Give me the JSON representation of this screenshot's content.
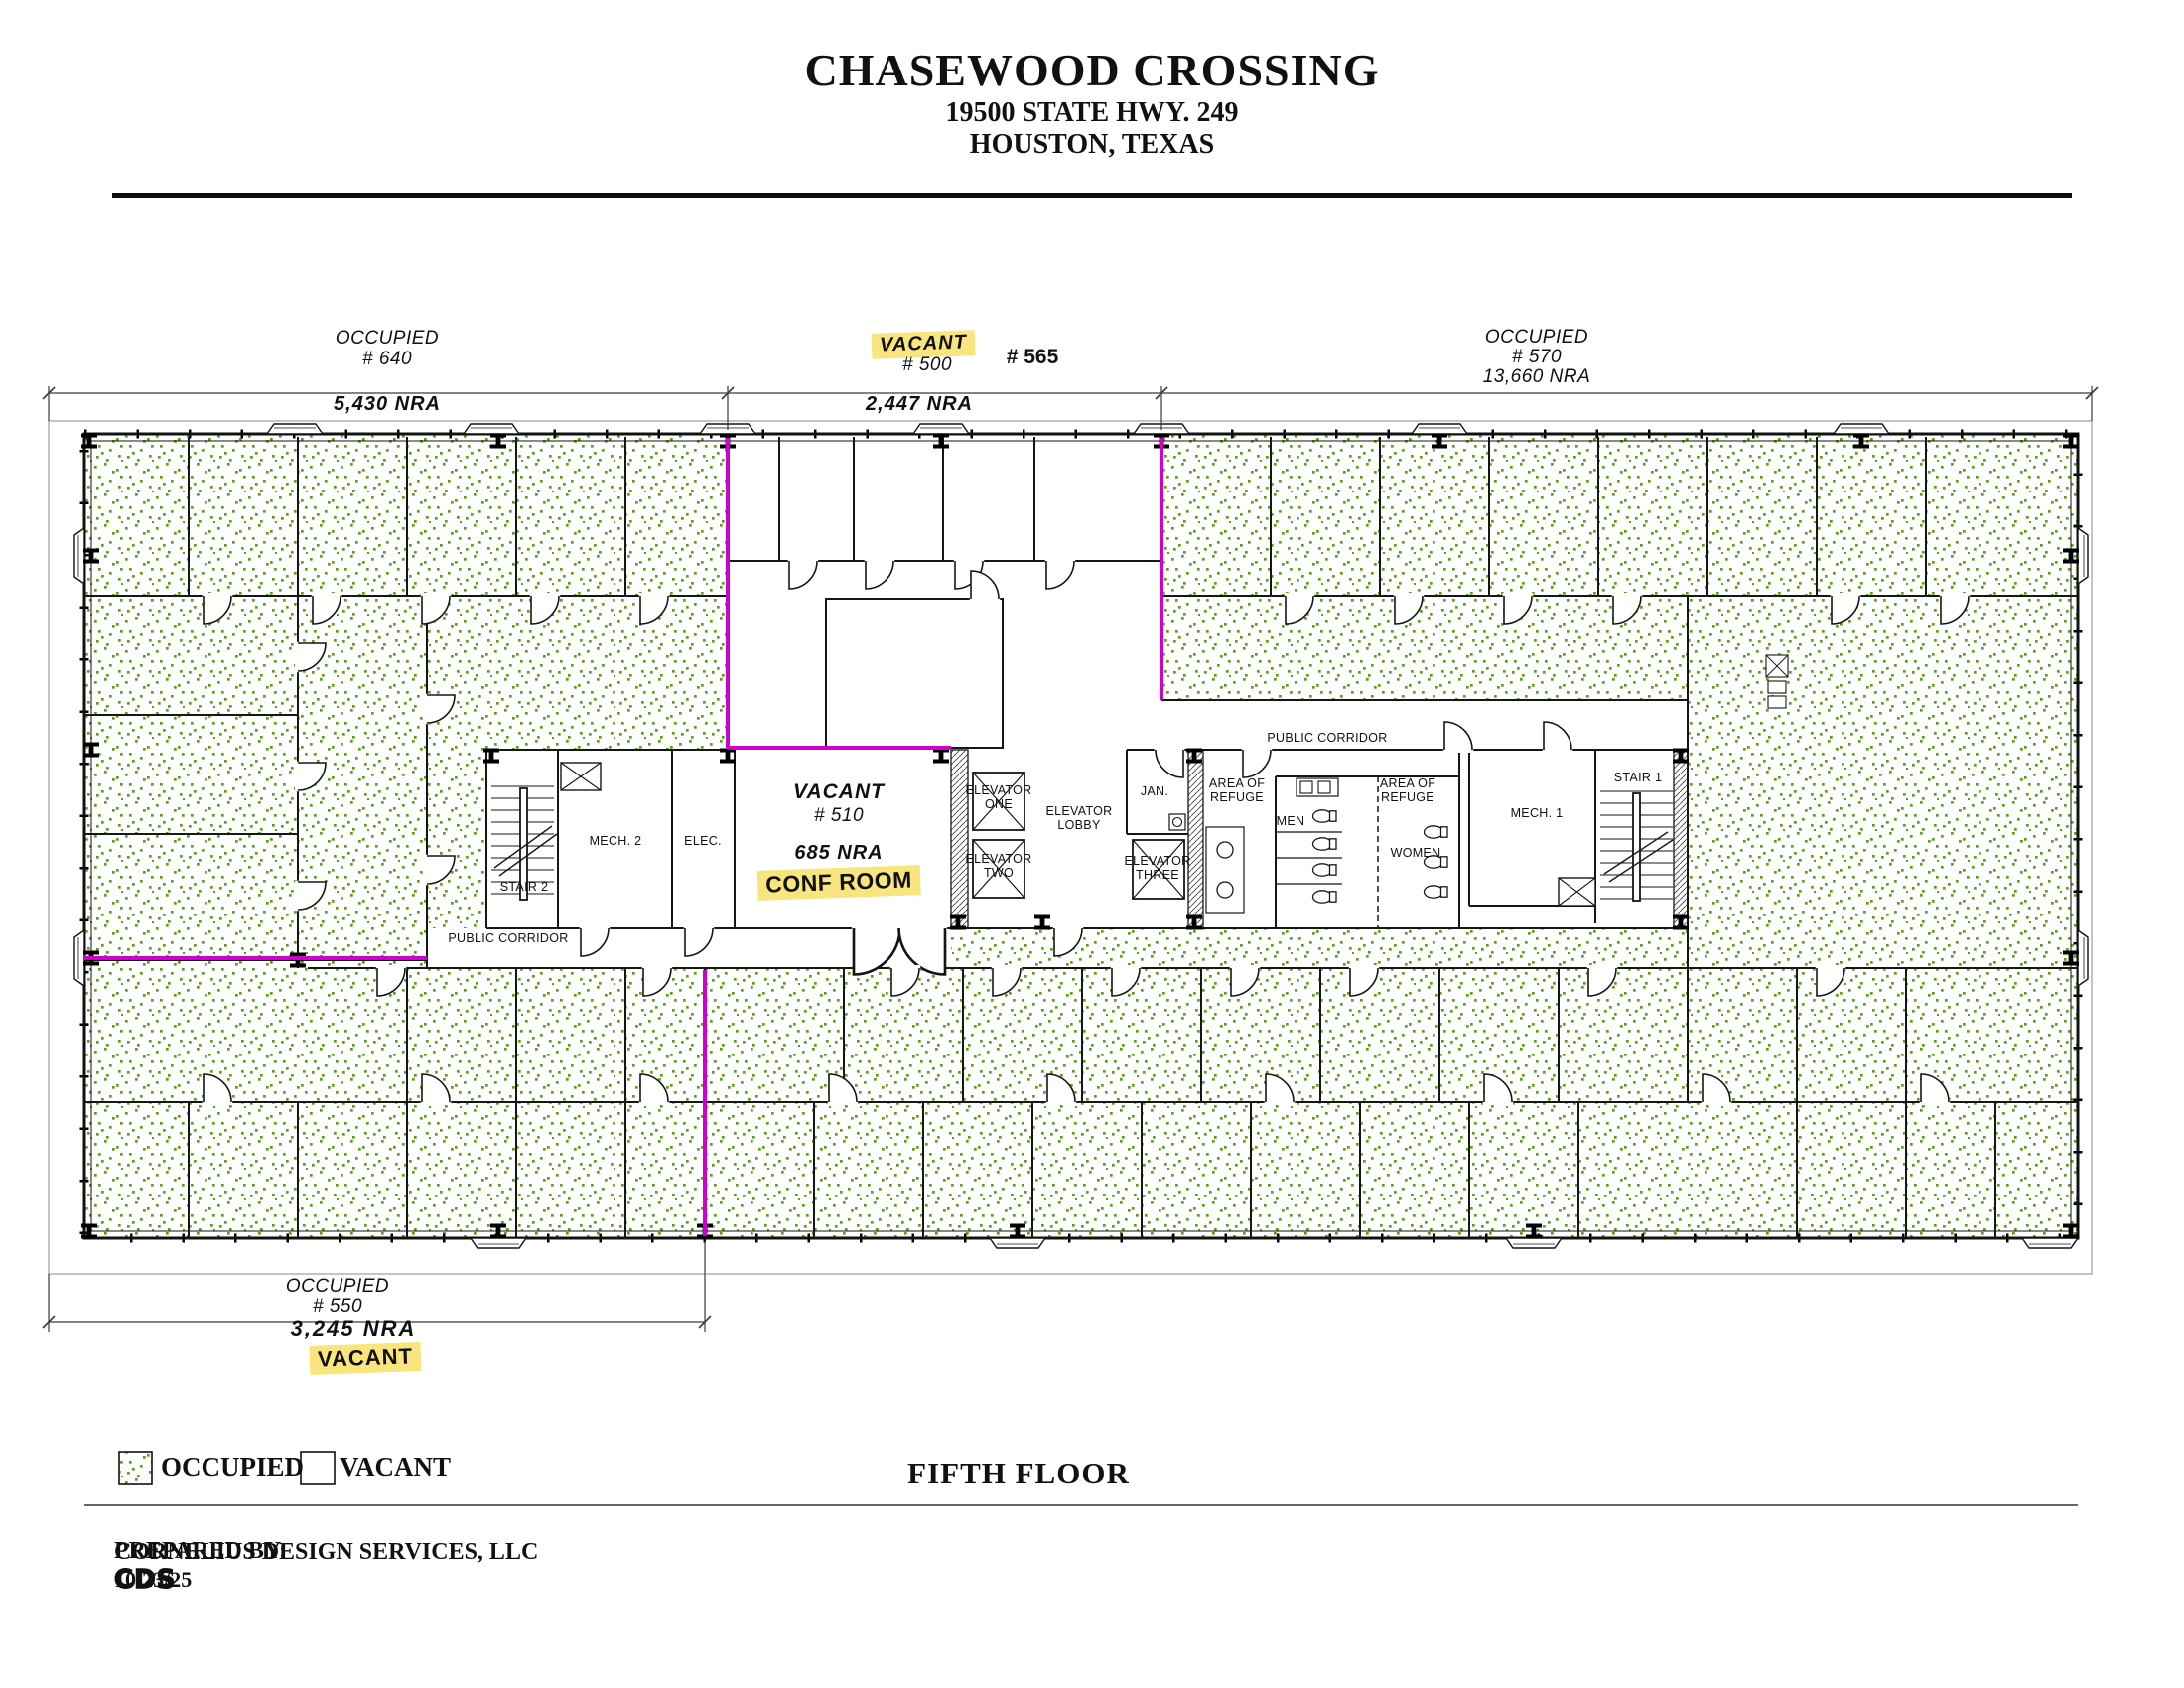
{
  "header": {
    "title": "CHASEWOOD CROSSING",
    "address_line1": "19500 STATE HWY. 249",
    "address_line2": "HOUSTON, TEXAS"
  },
  "suites": {
    "s640": {
      "status": "OCCUPIED",
      "number": "# 640",
      "nra": "5,430 NRA"
    },
    "s500": {
      "status": "VACANT",
      "number": "# 500",
      "adjacent_number": "# 565",
      "nra": "2,447 NRA"
    },
    "s570": {
      "status": "OCCUPIED",
      "number": "# 570",
      "nra": "13,660 NRA"
    },
    "s510": {
      "status": "VACANT",
      "number": "# 510",
      "nra": "685 NRA",
      "conf_label": "CONF ROOM"
    },
    "s550": {
      "status": "OCCUPIED",
      "number": "# 550",
      "nra": "3,245 NRA",
      "vacant_tag": "VACANT"
    }
  },
  "rooms": {
    "elevator_one": "ELEVATOR\nONE",
    "elevator_two": "ELEVATOR\nTWO",
    "elevator_three": "ELEVATOR\nTHREE",
    "elevator_lobby": "ELEVATOR\nLOBBY",
    "jan": "JAN.",
    "area_of_refuge_1": "AREA OF\nREFUGE",
    "area_of_refuge_2": "AREA OF\nREFUGE",
    "men": "MEN",
    "women": "WOMEN",
    "mech_1": "MECH. 1",
    "mech_2": "MECH. 2",
    "elec": "ELEC.",
    "stair_1": "STAIR 1",
    "stair_2": "STAIR 2",
    "public_corridor_right": "PUBLIC CORRIDOR",
    "public_corridor_left": "PUBLIC CORRIDOR"
  },
  "legend": {
    "occupied": "OCCUPIED",
    "vacant": "VACANT"
  },
  "floor_label": "FIFTH FLOOR",
  "footer": {
    "prepared_by": "PREPARED BY:",
    "logo": "CDS",
    "company": "CORNELIUS DESIGN SERVICES, LLC",
    "date": "10/23/25"
  },
  "colors": {
    "occupied_dot": "#5aa11a",
    "vacant_boundary": "#cf00cf",
    "highlight": "#f9e57e",
    "wall": "#161616"
  }
}
